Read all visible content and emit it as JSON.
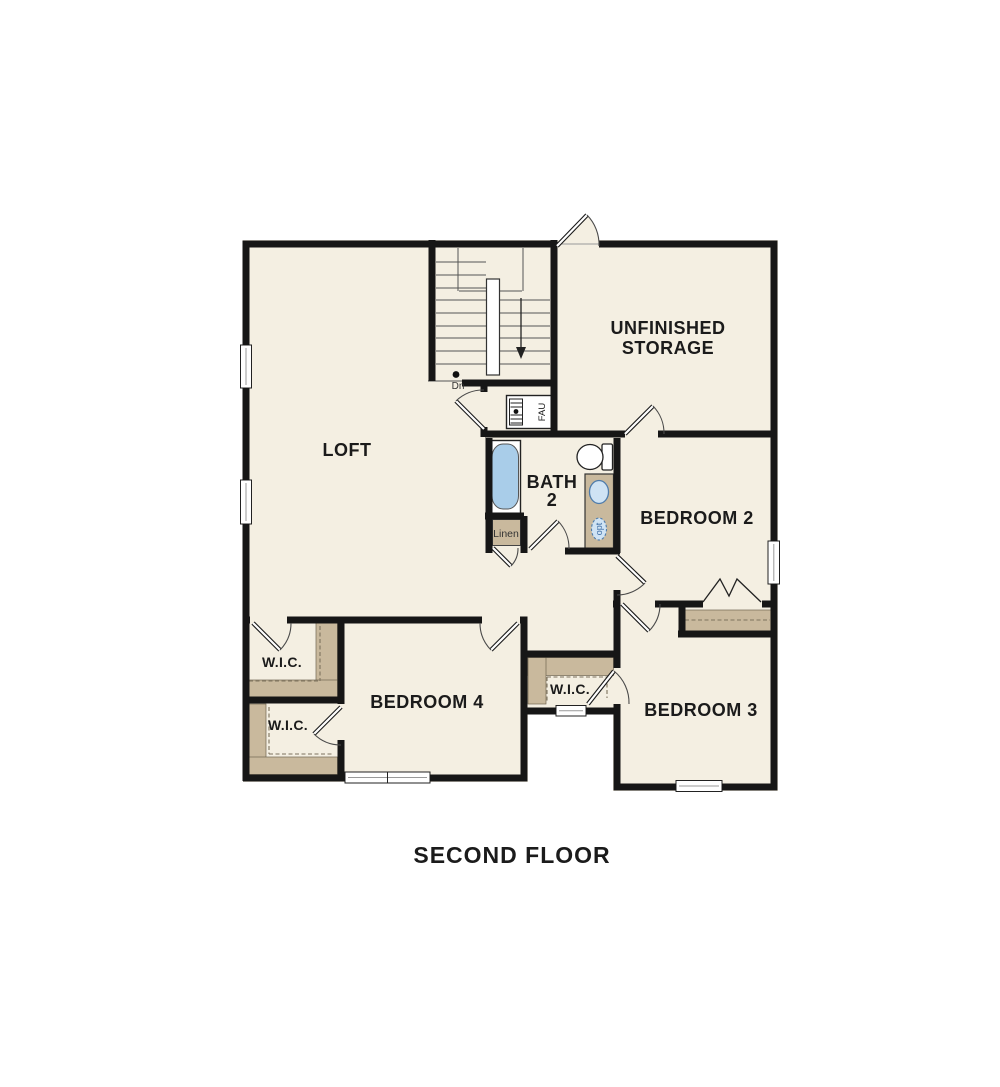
{
  "title": "SECOND FLOOR",
  "labels": {
    "loft": "LOFT",
    "storage_line1": "UNFINISHED",
    "storage_line2": "STORAGE",
    "bath_line1": "BATH",
    "bath_line2": "2",
    "bedroom2": "BEDROOM 2",
    "bedroom3": "BEDROOM 3",
    "bedroom4": "BEDROOM 4",
    "wic_loft": "W.I.C.",
    "wic_bedroom4": "W.I.C.",
    "wic_bedroom3": "W.I.C.",
    "linen": "Linen",
    "fau": "FAU",
    "stair_direction": "Dn",
    "opt": "opt"
  },
  "colors": {
    "background": "#ffffff",
    "room_fill": "#f4efe2",
    "wall": "#161616",
    "shelf": "#c9b99d",
    "tub_fill": "#a9cde9",
    "fixture_blue": "#4f7cab",
    "dashed_shelf_line": "#7d725d"
  }
}
